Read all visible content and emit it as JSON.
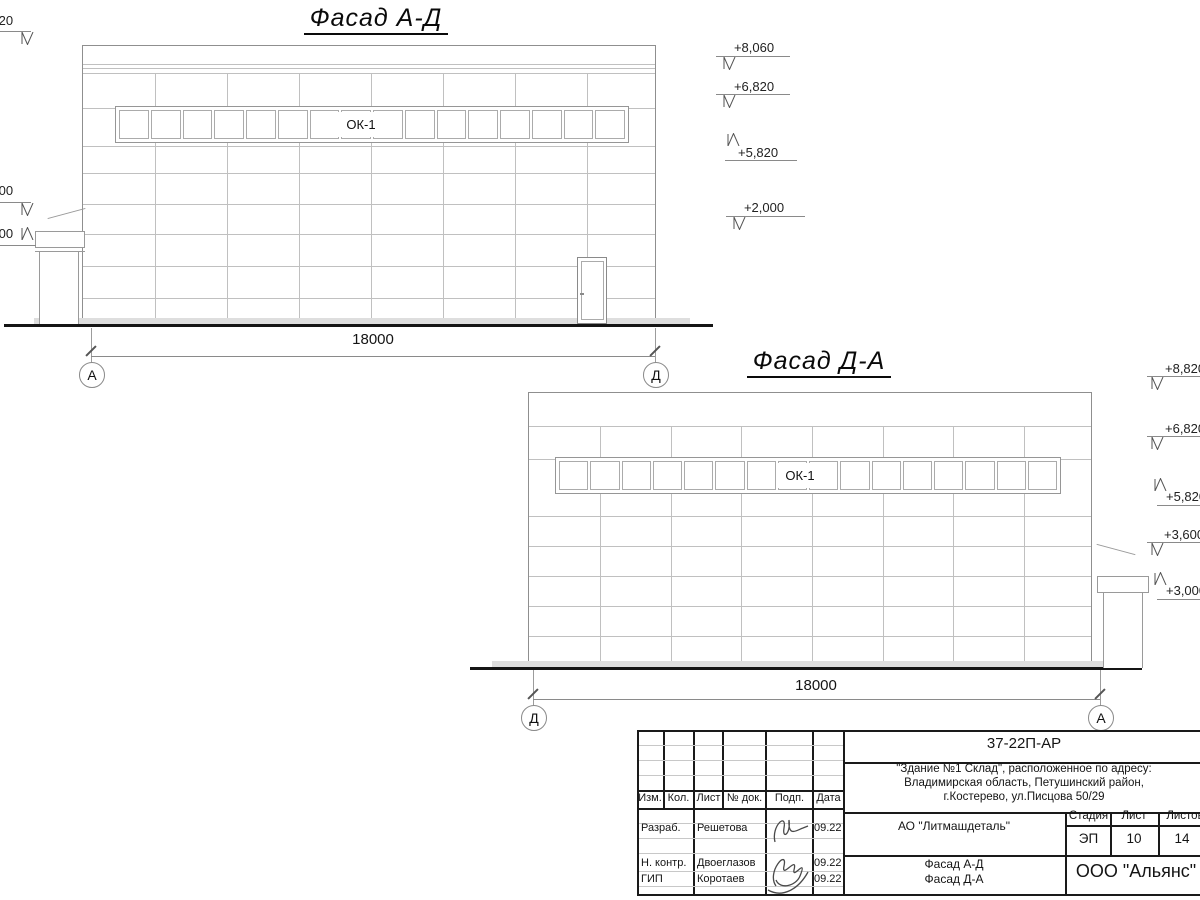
{
  "sheet": {
    "facade1": {
      "title": "Фасад А-Д",
      "window_label": "ОК-1",
      "dimension": "18000",
      "axis_left": "А",
      "axis_right": "Д",
      "marks_left": [
        "+8,820",
        "+3,600",
        "+3,000"
      ],
      "marks_right": [
        "+8,060",
        "+6,820",
        "+5,820",
        "+2,000"
      ]
    },
    "facade2": {
      "title": "Фасад Д-А",
      "window_label": "ОК-1",
      "dimension": "18000",
      "axis_left": "Д",
      "axis_right": "А",
      "marks_right": [
        "+8,820",
        "+6,820",
        "+5,820",
        "+3,600",
        "+3,000"
      ]
    },
    "titleblock": {
      "doc_code": "37-22П-АР",
      "address_line1": "\"Здание №1 Склад\", расположенное по адресу:",
      "address_line2": "Владимирская область, Петушинский район,",
      "address_line3": "г.Костерево, ул.Писцова 50/29",
      "client": "АО \"Литмашдеталь\"",
      "columns": {
        "izm": "Изм.",
        "kol": "Кол.",
        "list": "Лист",
        "doc": "№ док.",
        "podp": "Подп.",
        "data": "Дата"
      },
      "rows": [
        {
          "role": "Разраб.",
          "name": "Решетова",
          "date": "09.22"
        },
        {
          "role": "Н. контр.",
          "name": "Двоеглазов",
          "date": "09.22"
        },
        {
          "role": "ГИП",
          "name": "Коротаев",
          "date": "09.22"
        }
      ],
      "stage_label": "Стадия",
      "sheet_label": "Лист",
      "sheets_label": "Листов",
      "stage": "ЭП",
      "sheet_no": "10",
      "sheets_total": "14",
      "drawing_name_line1": "Фасад А-Д",
      "drawing_name_line2": "Фасад Д-А",
      "company": "ООО \"Альянс\""
    }
  }
}
